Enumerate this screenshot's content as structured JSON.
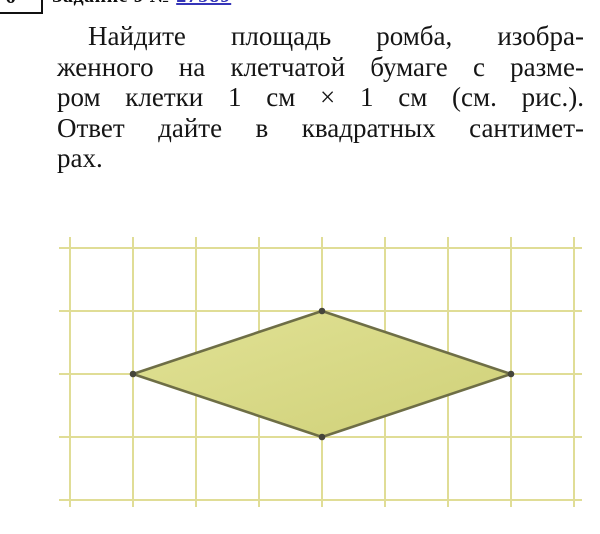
{
  "header": {
    "question_box_number": "6",
    "task_label": "Задание 9 №",
    "task_link": "27589",
    "link_color": "#3535b8"
  },
  "problem": {
    "lines": [
      "Найдите площадь ромба, изобра-",
      "женного на клетчатой бумаге с разме-",
      "ром клетки 1 см × 1 см (см. рис.).",
      "Ответ дайте в квадратных сантимет-",
      "рах."
    ],
    "full_text": "Найдите площадь ромба, изображенного на клетчатой бумаге с размером клетки 1 см × 1 см (см. рис.). Ответ дайте в квадратных сантиметрах."
  },
  "figure": {
    "type": "grid-figure",
    "shape": "rhombus",
    "cell_size_label": "1 см × 1 см",
    "grid": {
      "columns": 8,
      "rows": 4
    },
    "rhombus_vertices_cells": [
      [
        1,
        2
      ],
      [
        4,
        1
      ],
      [
        7,
        2
      ],
      [
        4,
        3
      ]
    ],
    "diagonals_cells": {
      "horizontal": 6,
      "vertical": 2
    },
    "colors": {
      "grid_line": "#e0dd96",
      "fill_light": "#e1e295",
      "fill_dark": "#cfd078",
      "stroke": "#6e6e46",
      "dot": "#45453a"
    }
  }
}
